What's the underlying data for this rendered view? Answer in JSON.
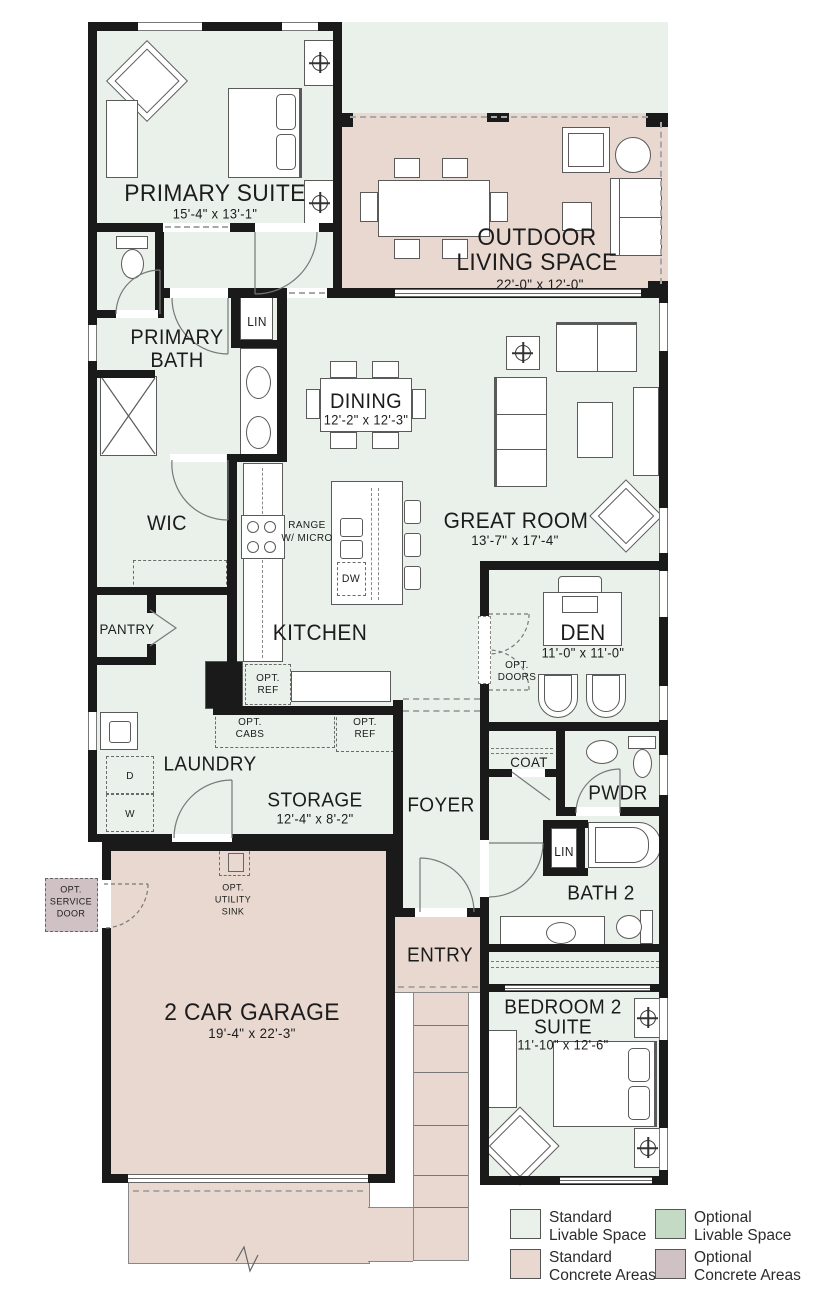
{
  "plan": {
    "rooms": {
      "primary_suite": {
        "name": "PRIMARY SUITE",
        "dims": "15'-4\" x 13'-1\""
      },
      "outdoor_living": {
        "line1": "OUTDOOR",
        "line2": "LIVING SPACE",
        "dims": "22'-0\" x 12'-0\""
      },
      "primary_bath": {
        "line1": "PRIMARY",
        "line2": "BATH"
      },
      "linen_1": {
        "name": "LIN"
      },
      "dining": {
        "name": "DINING",
        "dims": "12'-2\" x 12'-3\""
      },
      "great_room": {
        "name": "GREAT ROOM",
        "dims": "13'-7\" x 17'-4\""
      },
      "wic": {
        "name": "WIC"
      },
      "kitchen": {
        "name": "KITCHEN"
      },
      "den": {
        "name": "DEN",
        "dims": "11'-0\" x 11'-0\""
      },
      "pantry": {
        "name": "PANTRY"
      },
      "laundry": {
        "name": "LAUNDRY"
      },
      "storage": {
        "name": "STORAGE",
        "dims": "12'-4\" x 8'-2\""
      },
      "foyer": {
        "name": "FOYER"
      },
      "coat": {
        "name": "COAT"
      },
      "powder": {
        "name": "PWDR"
      },
      "bath_2": {
        "name": "BATH 2"
      },
      "linen_2": {
        "name": "LIN"
      },
      "entry": {
        "name": "ENTRY"
      },
      "garage": {
        "name": "2 CAR GARAGE",
        "dims": "19'-4\" x 22'-3\""
      },
      "bedroom_2": {
        "line1": "BEDROOM 2",
        "line2": "SUITE",
        "dims": "11'-10\" x 12'-6\""
      }
    },
    "annotations": {
      "range": {
        "line1": "RANGE",
        "line2": "W/ MICRO"
      },
      "dishwasher": "DW",
      "washer": "W",
      "dryer": "D",
      "opt_ref_kitchen": {
        "line1": "OPT.",
        "line2": "REF"
      },
      "opt_cabs": {
        "line1": "OPT.",
        "line2": "CABS"
      },
      "opt_ref_storage": {
        "line1": "OPT.",
        "line2": "REF"
      },
      "opt_doors": {
        "line1": "OPT.",
        "line2": "DOORS"
      },
      "opt_utility_sink": {
        "line1": "OPT.",
        "line2": "UTILITY",
        "line3": "SINK"
      },
      "opt_service_door": {
        "line1": "OPT.",
        "line2": "SERVICE",
        "line3": "DOOR"
      }
    },
    "legend": {
      "items": [
        {
          "line1": "Standard",
          "line2": "Livable Space",
          "color": "#e9f1ea"
        },
        {
          "line1": "Optional",
          "line2": "Livable Space",
          "color": "#c5dac5"
        },
        {
          "line1": "Standard",
          "line2": "Concrete Areas",
          "color": "#e8d8d0"
        },
        {
          "line1": "Optional",
          "line2": "Concrete Areas",
          "color": "#d0c2c4"
        }
      ]
    },
    "colors": {
      "livable": "#e9f1ea",
      "optional_livable": "#c5dac5",
      "concrete": "#e8d8d0",
      "optional_concrete": "#d0c2c4",
      "wall": "#1a1a1a"
    }
  }
}
